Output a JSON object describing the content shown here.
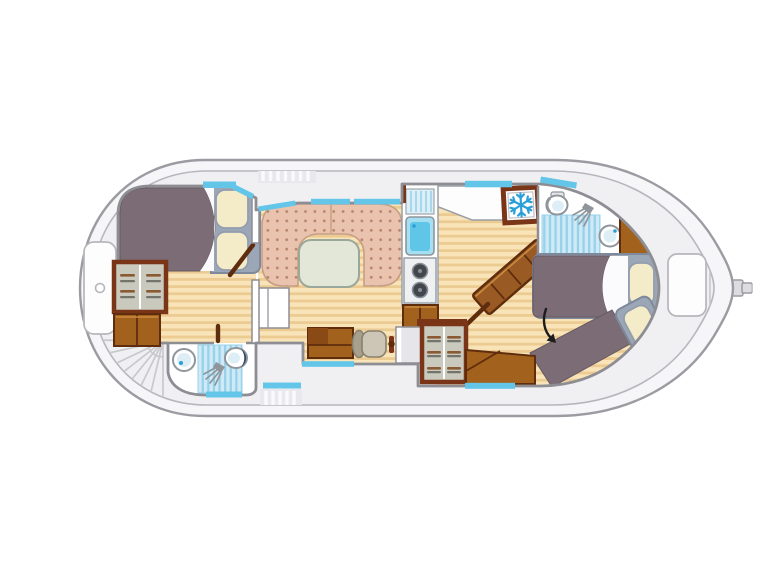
{
  "figure": {
    "kind": "canal-boat interior floor plan, top view",
    "orientation": "bow at left (rounded), stern at right (pointed with rudder)"
  },
  "palette": {
    "page_bg": "#ffffff",
    "hull_fill": "#f6f6f8",
    "hull_band": "#f0f0f3",
    "hull_stroke": "#9b9ba1",
    "hull_inner_stroke": "#b6b6bc",
    "deck_line": "#c8c8cd",
    "walk_base": "#e9e9ed",
    "walk_line": "#fafafc",
    "locker_fill": "#fdfdfe",
    "wall_fill": "#ffffff",
    "wall_stroke": "#8d8d94",
    "wood_base": "#f8e4b8",
    "wood_stripe": "#eccb92",
    "window": "#63c6e8",
    "sofa": "#eac3ae",
    "sofa_dot": "#b5846b",
    "sofa_edge": "#c79e86",
    "seam": "#d2a88f",
    "table": "#e3e7d7",
    "table_edge": "#9aa79b",
    "blanket": "#7b6c76",
    "blanket_edge": "#675a63",
    "sheet": "#fbfbfd",
    "mattress": "#9ba6b6",
    "mattress_edge": "#7e8a9c",
    "pillow": "#f4ecc9",
    "pillow_edge": "#939dad",
    "wood_dark": "#5f2d0d",
    "wood_dark2": "#8a4a16",
    "wood_mid": "#a2611d",
    "wood_frame": "#7a3417",
    "wood_light": "#c98c3f",
    "shelf_bg": "#c9c9bd",
    "shelf_bar": "#8a5a33",
    "shelf_bar2": "#74746c",
    "tile_base": "#cfeaf6",
    "tile_stripe": "#97d2ea",
    "fixture": "#8f959b",
    "basin": "#ddeef7",
    "toilet_crescent": "#2b4a63",
    "faucet": "#2a9fd8",
    "counter": "#fdfdfe",
    "counter_edge": "#9aa0a8",
    "stove": "#eef0f2",
    "burner": "#43474d",
    "burner_ring": "#8a9098",
    "snowflake": "#2a9fd8",
    "arrow": "#1c1c1e",
    "console": "#e6e6ea",
    "chair": "#cdc6b6",
    "chair_dark": "#a89f8d",
    "chair_edge": "#86806f",
    "sink_blue": "#5fc6e8",
    "sink_pale": "#a5dff2",
    "stair_tread": "#9a5a24",
    "rudder": "#dddde1"
  },
  "rooms": [
    {
      "id": "bow-cabin",
      "furniture": [
        "double-bed",
        "two-pillows",
        "shelved-wardrobe",
        "dresser",
        "open-door"
      ]
    },
    {
      "id": "forward-bathroom",
      "fixtures": [
        "washbasin",
        "shower",
        "toilet",
        "door"
      ]
    },
    {
      "id": "saloon",
      "furniture": [
        "u-shaped-sofa",
        "table",
        "side-cabinet"
      ]
    },
    {
      "id": "galley",
      "fixtures": [
        "draining-board",
        "sink",
        "two-burner-stove",
        "storage-cabinet",
        "refrigerator"
      ]
    },
    {
      "id": "helm-station",
      "furniture": [
        "bench",
        "swivel-chair",
        "steering-wheel",
        "console",
        "shelved-wardrobe"
      ]
    },
    {
      "id": "companionway",
      "features": [
        "diagonal-steps",
        "open-door"
      ]
    },
    {
      "id": "aft-bathroom",
      "fixtures": [
        "toilet",
        "shower",
        "washbasin",
        "cabinet"
      ]
    },
    {
      "id": "aft-cabin",
      "furniture": [
        "single-bed",
        "angled-single-bed",
        "cabinet"
      ],
      "annotations": [
        "direction-arrow"
      ]
    }
  ],
  "deck_features": [
    "bow-locker",
    "fan-steps",
    "walkway-treads",
    "stern-seat",
    "rudder",
    "window-strips"
  ],
  "icons": [
    {
      "name": "snowflake-icon",
      "meaning": "refrigerator"
    },
    {
      "name": "shower-spray-icon",
      "meaning": "shower"
    },
    {
      "name": "direction-arrow-icon",
      "meaning": "access to aft berth"
    }
  ]
}
